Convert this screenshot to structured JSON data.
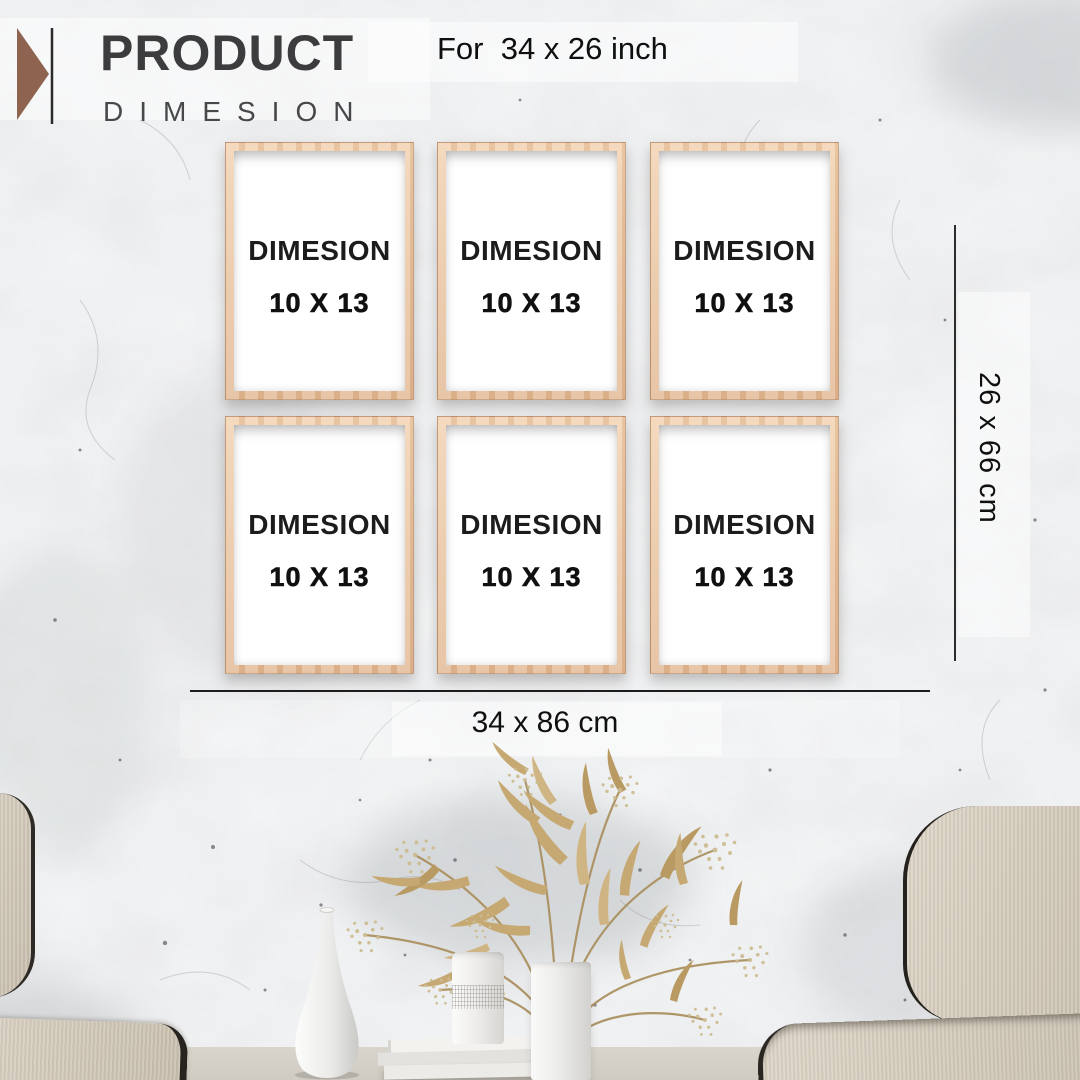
{
  "header": {
    "title": "PRODUCT",
    "subtitle": "DIMESION",
    "note": "For  34 x 26 inch"
  },
  "frames": {
    "items": [
      {
        "label": "DIMESION",
        "size": "10 X 13"
      },
      {
        "label": "DIMESION",
        "size": "10 X 13"
      },
      {
        "label": "DIMESION",
        "size": "10 X 13"
      },
      {
        "label": "DIMESION",
        "size": "10 X 13"
      },
      {
        "label": "DIMESION",
        "size": "10 X 13"
      },
      {
        "label": "DIMESION",
        "size": "10 X 13"
      }
    ]
  },
  "dimensions": {
    "vertical": "26 x 66 cm",
    "horizontal": "34 x 86 cm"
  },
  "colors": {
    "accent_brown": "#8e6450",
    "frame_wood": "#eac59f",
    "wall_gray": "#e3e5e7",
    "plant_gold": "#c2a46e",
    "text_dark": "#3c3c3e"
  }
}
